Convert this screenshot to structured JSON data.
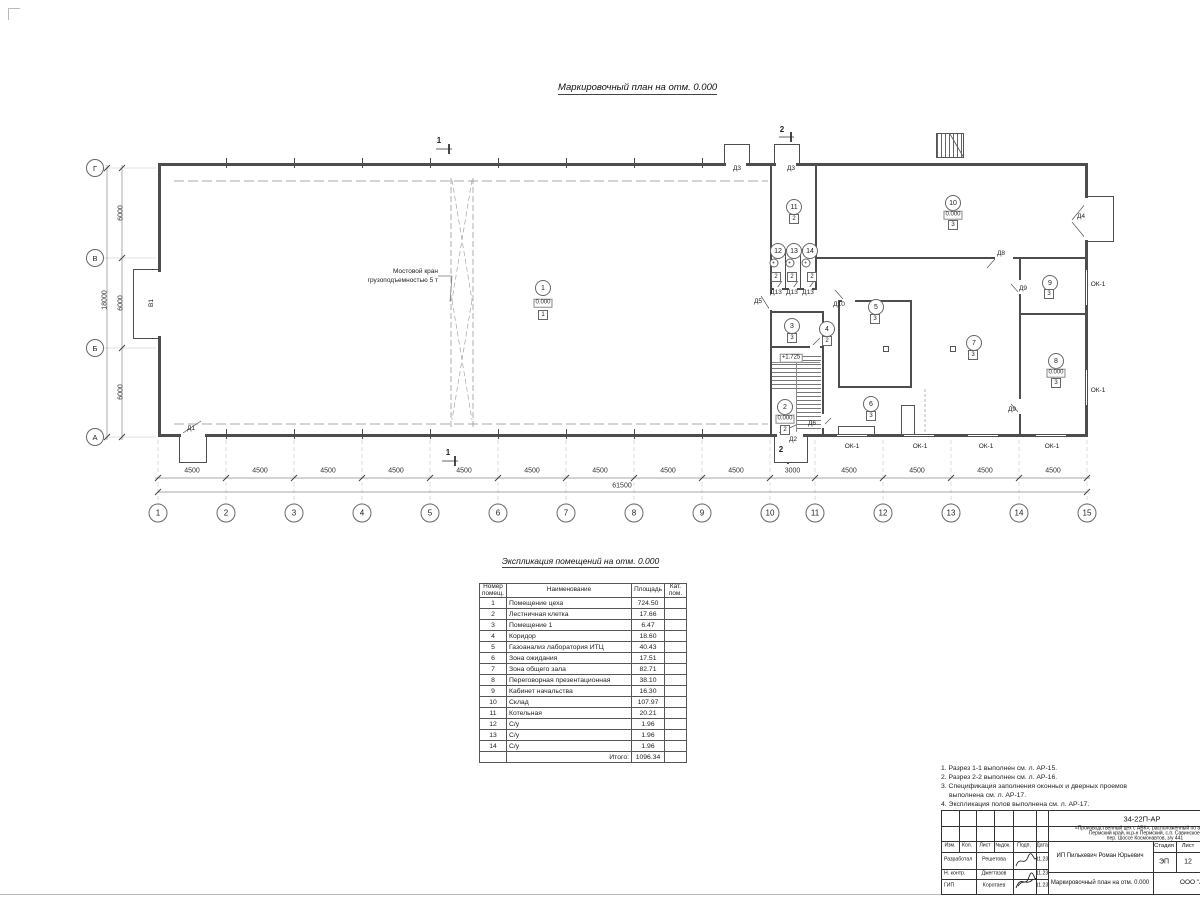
{
  "sheet": {
    "plan_title": "Маркировочный план  на отм. 0.000",
    "table_title": "Экспликация помещений на отм. 0.000"
  },
  "plan": {
    "crane_label_line1": "Мостовой кран",
    "crane_label_line2": "грузоподъемностью 5 т",
    "gate_label": "В1",
    "window_label": "ОК-1",
    "section_1": "1",
    "section_2": "2",
    "landing_elevation": "+1.725",
    "grid_cols": [
      "1",
      "2",
      "3",
      "4",
      "5",
      "6",
      "7",
      "8",
      "9",
      "10",
      "11",
      "12",
      "13",
      "14",
      "15"
    ],
    "grid_rows": [
      "Г",
      "В",
      "Б",
      "А"
    ],
    "dims_bottom": [
      "4500",
      "4500",
      "4500",
      "4500",
      "4500",
      "4500",
      "4500",
      "4500",
      "4500",
      "3000",
      "4500",
      "4500",
      "4500",
      "4500"
    ],
    "dim_total_bottom": "61500",
    "dims_left": [
      "6000",
      "6000",
      "6000"
    ],
    "dim_total_left": "18000",
    "doors": [
      "Д1",
      "Д2",
      "Д3",
      "Д3",
      "Д4",
      "Д5",
      "Д6",
      "Д8",
      "Д9",
      "Д9",
      "Д10",
      "Д13",
      "Д13",
      "Д13"
    ],
    "rooms": [
      {
        "num": "1",
        "elev": "0.000",
        "floor": "1"
      },
      {
        "num": "2",
        "elev": "0.000",
        "floor": "2"
      },
      {
        "num": "3",
        "floor": "3"
      },
      {
        "num": "4",
        "floor": "2"
      },
      {
        "num": "5",
        "floor": "3"
      },
      {
        "num": "6",
        "floor": "3"
      },
      {
        "num": "7",
        "floor": "3"
      },
      {
        "num": "8",
        "elev": "0.000",
        "floor": "3"
      },
      {
        "num": "9",
        "floor": "3"
      },
      {
        "num": "10",
        "elev": "0.000",
        "floor": "3"
      },
      {
        "num": "11",
        "floor": "2"
      },
      {
        "num": "12",
        "floor": "2"
      },
      {
        "num": "13",
        "floor": "2"
      },
      {
        "num": "14",
        "floor": "2"
      }
    ]
  },
  "table": {
    "headers": {
      "num": "Номер помещ.",
      "name": "Наименование",
      "area": "Площадь",
      "cat": "Кат. пом."
    },
    "rows": [
      [
        "1",
        "Помещение цеха",
        "724.50"
      ],
      [
        "2",
        "Лестничная клетка",
        "17.66"
      ],
      [
        "3",
        "Помещение 1",
        "6.47"
      ],
      [
        "4",
        "Коридор",
        "18.60"
      ],
      [
        "5",
        "Газоанализ лаборатория ИТЦ",
        "40.43"
      ],
      [
        "6",
        "Зона ожидания",
        "17.51"
      ],
      [
        "7",
        "Зона общего зала",
        "82.71"
      ],
      [
        "8",
        "Переговорная презентационная",
        "38.10"
      ],
      [
        "9",
        "Кабинет начальства",
        "16.30"
      ],
      [
        "10",
        "Склад",
        "107.97"
      ],
      [
        "11",
        "Котельная",
        "20.21"
      ],
      [
        "12",
        "С/у",
        "1.96"
      ],
      [
        "13",
        "С/у",
        "1.96"
      ],
      [
        "14",
        "С/у",
        "1.96"
      ]
    ],
    "total_label": "Итого:",
    "total_value": "1096.34"
  },
  "notes": [
    "1. Разрез 1-1 выполнен см. л. АР-15.",
    "2. Разрез 2-2 выполнен см. л. АР-16.",
    "3. Спецификация заполнения оконных и дверных проемов выполнена см. л. АР-17.",
    "4. Экспликация полов выполнена см. л. АР-17."
  ],
  "titleblock": {
    "doc_number": "34-22П-АР",
    "project_line1": "«Производственный цех с АБК», расположенный по адресу:",
    "project_line2": "Пермский край, м.р-н Пермский, с.п. Савинское,",
    "project_line3": "пер. Шоссе Космонавтов, з/у 441",
    "cols": [
      "Изм.",
      "Кол.",
      "Лист",
      "№док.",
      "Подп.",
      "Дата"
    ],
    "rows": [
      {
        "role": "Разработал",
        "name": "Решетова",
        "date": "11.23"
      },
      {
        "role": "Н. контр.",
        "name": "Джегтазов",
        "date": "11.23"
      },
      {
        "role": "ГИП",
        "name": "Коротаев",
        "date": "11.23"
      }
    ],
    "client": "ИП Пилькевич Роман Юрьевич",
    "sheet_title": "Маркировочный план на отм. 0.000",
    "stage_label": "Стадия",
    "sheet_label": "Лист",
    "stage_value": "ЭП",
    "sheet_value": "12",
    "company": "ООО \"Альф"
  }
}
